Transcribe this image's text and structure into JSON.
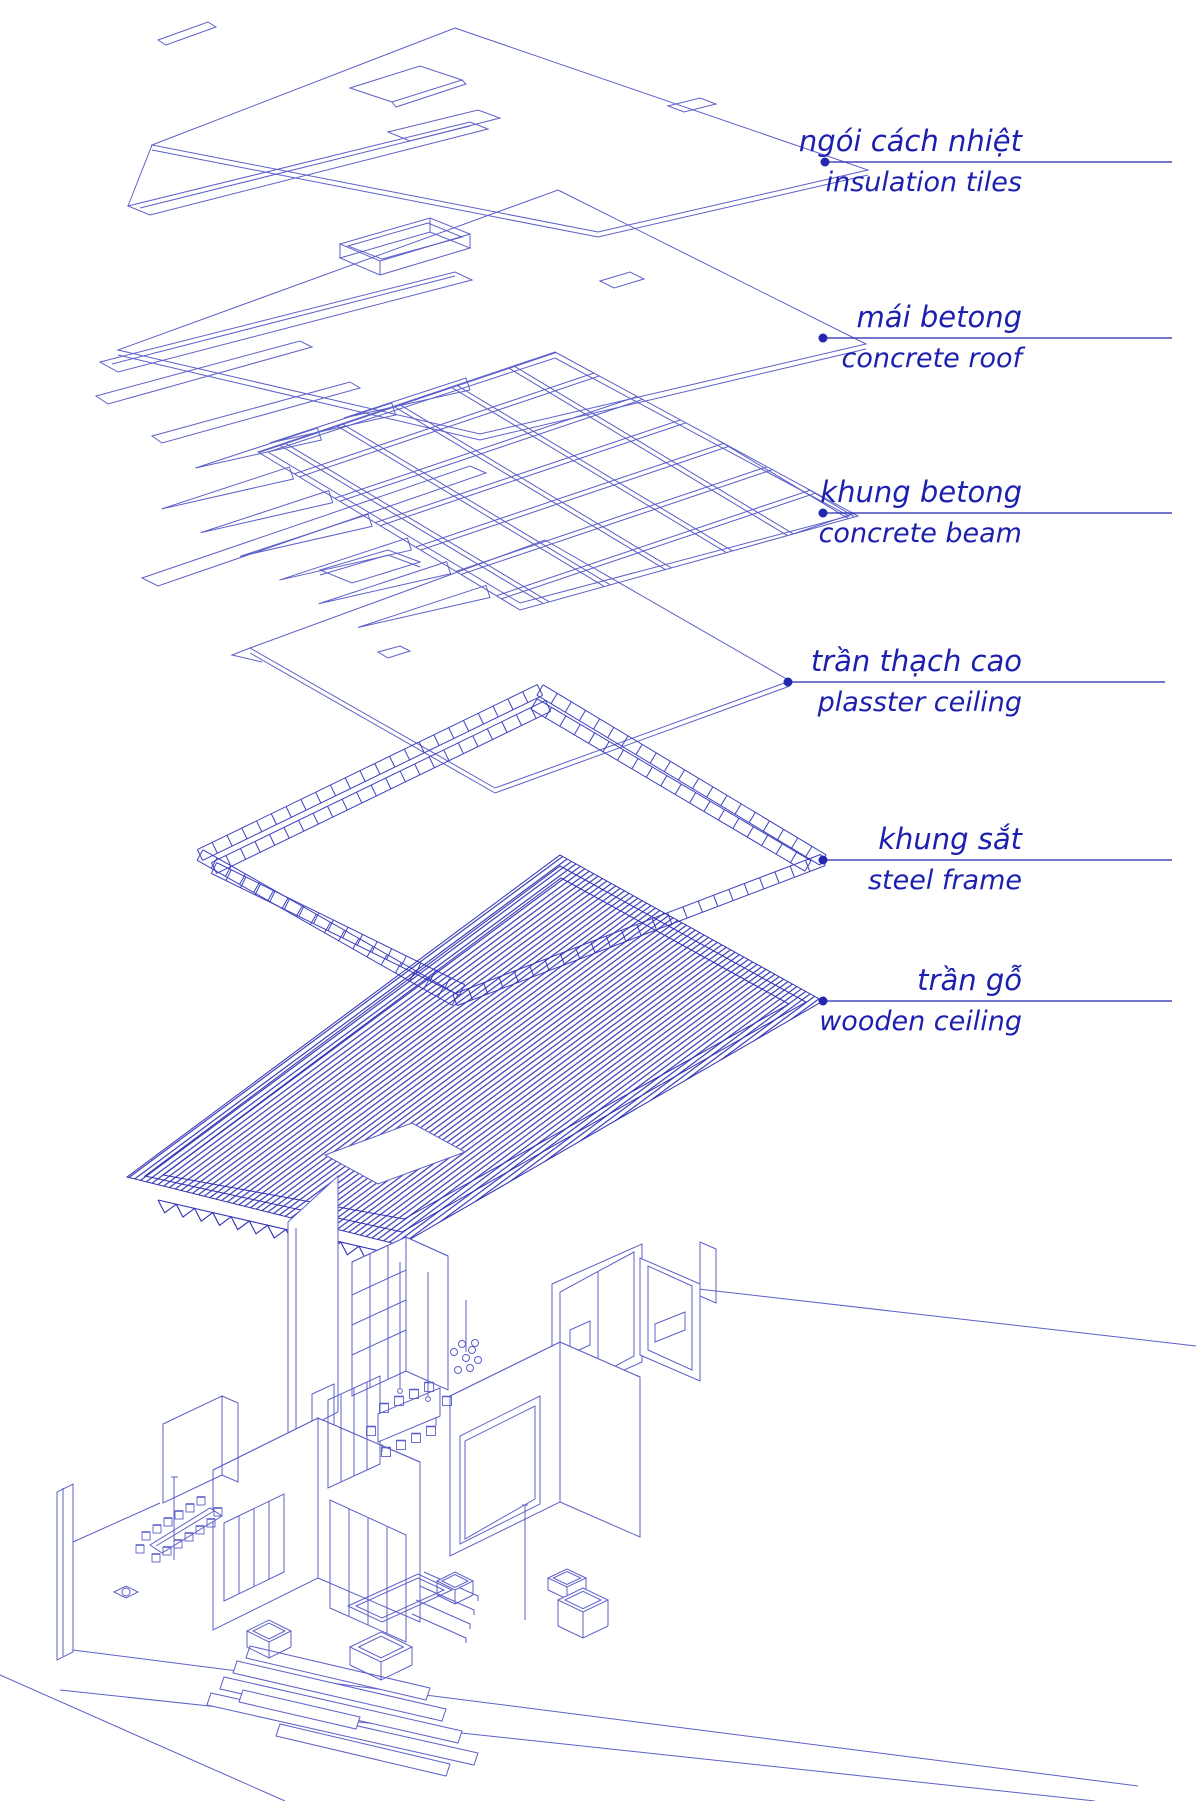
{
  "title": "Exploded axonometric roof construction diagram",
  "colors": {
    "ink": "#1d1fae",
    "line": "#5c60c8",
    "dark": "#2e31b2",
    "mid": "#3d41bd",
    "background": "#ffffff"
  },
  "layers": [
    {
      "id": "insulation-tiles",
      "vi": "ngói cách nhiệt",
      "en": "insulation tiles"
    },
    {
      "id": "concrete-roof",
      "vi": "mái betong",
      "en": "concrete roof"
    },
    {
      "id": "concrete-beam",
      "vi": "khung betong",
      "en": "concrete beam"
    },
    {
      "id": "plaster-ceiling",
      "vi": "trần thạch cao",
      "en": "plasster ceiling"
    },
    {
      "id": "steel-frame",
      "vi": "khung sắt",
      "en": "steel frame"
    },
    {
      "id": "wooden-ceiling",
      "vi": "trần gỗ",
      "en": "wooden ceiling"
    }
  ]
}
